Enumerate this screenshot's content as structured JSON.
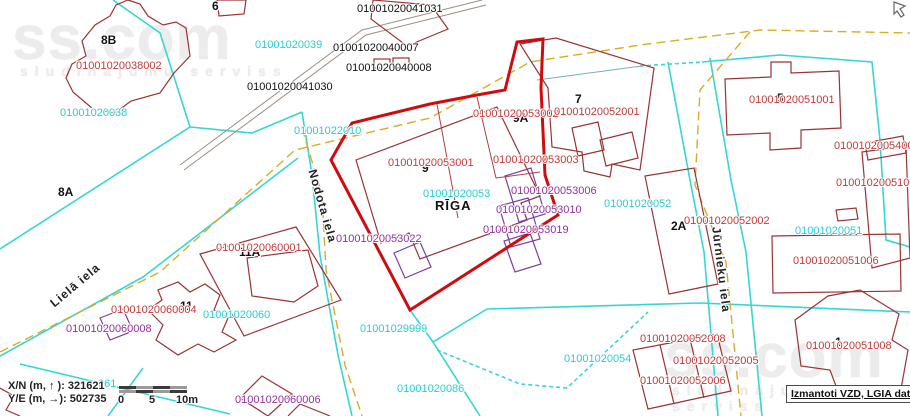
{
  "map_title": "Cadastral map",
  "city_label": "RĪGA",
  "watermark": {
    "brand": "ss.com",
    "slogan": "sludinājumu serviss"
  },
  "attribution": "Izmantoti VZD, LGIA dati",
  "info_panel": {
    "x_line": "X/N (m, ↑ ): 321621",
    "y_line": "Y/E (m, →): 502735"
  },
  "scale_bar": {
    "ticks": [
      "0",
      "5",
      "10m"
    ]
  },
  "streets": [
    "Lielā iela",
    "Nodota iela",
    "Jūrnieku iela"
  ],
  "selected_parcel": "01001020053",
  "colors": {
    "boundary_cyan": "#35d6d6",
    "road_yellow": "#d8ac28",
    "parcel_dark_red": "#993335",
    "selected_parcel_red": "#cf0b0d",
    "building_purple": "#7b3fa0",
    "label_cyan": "#2accd0",
    "label_red": "#c03a3a",
    "label_purple": "#93319c"
  },
  "labels": [
    {
      "text": "01001020041031",
      "x": 357,
      "y": 4,
      "cls": "num-black"
    },
    {
      "text": "01001020040007",
      "x": 333,
      "y": 43,
      "cls": "num-black"
    },
    {
      "text": "01001020040008",
      "x": 346,
      "y": 63,
      "cls": "num-black"
    },
    {
      "text": "01001020041030",
      "x": 247,
      "y": 82,
      "cls": "num-black"
    },
    {
      "text": "6",
      "x": 212,
      "y": 0,
      "cls": "addr"
    },
    {
      "text": "8B",
      "x": 101,
      "y": 34,
      "cls": "addr"
    },
    {
      "text": "8A",
      "x": 58,
      "y": 186,
      "cls": "addr"
    },
    {
      "text": "9",
      "x": 422,
      "y": 162,
      "cls": "addr"
    },
    {
      "text": "9A",
      "x": 513,
      "y": 112,
      "cls": "addr"
    },
    {
      "text": "7",
      "x": 575,
      "y": 93,
      "cls": "addr"
    },
    {
      "text": "2A",
      "x": 671,
      "y": 220,
      "cls": "addr"
    },
    {
      "text": "5",
      "x": 777,
      "y": 92,
      "cls": "addr"
    },
    {
      "text": "11A",
      "x": 239,
      "y": 246,
      "cls": "addr"
    },
    {
      "text": "11",
      "x": 180,
      "y": 300,
      "cls": "addr"
    },
    {
      "text": "1",
      "x": 835,
      "y": 336,
      "cls": "addr"
    },
    {
      "text": "RĪGA",
      "x": 435,
      "y": 199,
      "cls": "riga"
    },
    {
      "text": "01001020038002",
      "x": 76,
      "y": 61,
      "cls": "red"
    },
    {
      "text": "01001020053002",
      "x": 473,
      "y": 109,
      "cls": "red"
    },
    {
      "text": "01001020052001",
      "x": 554,
      "y": 107,
      "cls": "red"
    },
    {
      "text": "01001020053001",
      "x": 388,
      "y": 158,
      "cls": "red"
    },
    {
      "text": "01001020053003",
      "x": 493,
      "y": 155,
      "cls": "red"
    },
    {
      "text": "01001020051001",
      "x": 749,
      "y": 95,
      "cls": "red"
    },
    {
      "text": "01001020054002",
      "x": 834,
      "y": 141,
      "cls": "red"
    },
    {
      "text": "01001020051003",
      "x": 836,
      "y": 178,
      "cls": "red"
    },
    {
      "text": "01001020052002",
      "x": 684,
      "y": 216,
      "cls": "red"
    },
    {
      "text": "01001020051006",
      "x": 793,
      "y": 256,
      "cls": "red"
    },
    {
      "text": "01001020060001",
      "x": 216,
      "y": 243,
      "cls": "red"
    },
    {
      "text": "01001020060004",
      "x": 111,
      "y": 305,
      "cls": "red"
    },
    {
      "text": "01001020052008",
      "x": 640,
      "y": 334,
      "cls": "red"
    },
    {
      "text": "01001020052005",
      "x": 673,
      "y": 356,
      "cls": "red"
    },
    {
      "text": "01001020052006",
      "x": 640,
      "y": 376,
      "cls": "red"
    },
    {
      "text": "01001020051008",
      "x": 806,
      "y": 341,
      "cls": "red"
    },
    {
      "text": "01001020053006",
      "x": 511,
      "y": 186,
      "cls": "purple"
    },
    {
      "text": "01001020053010",
      "x": 496,
      "y": 205,
      "cls": "purple"
    },
    {
      "text": "01001020053019",
      "x": 483,
      "y": 225,
      "cls": "purple"
    },
    {
      "text": "01001020053022",
      "x": 336,
      "y": 234,
      "cls": "purple"
    },
    {
      "text": "01001020060008",
      "x": 66,
      "y": 324,
      "cls": "purple"
    },
    {
      "text": "01001020060006",
      "x": 235,
      "y": 395,
      "cls": "purple"
    },
    {
      "text": "01001020039",
      "x": 255,
      "y": 40,
      "cls": "cyan"
    },
    {
      "text": "01001020038",
      "x": 60,
      "y": 108,
      "cls": "cyan"
    },
    {
      "text": "01001022010",
      "x": 294,
      "y": 126,
      "cls": "cyan"
    },
    {
      "text": "01001020053",
      "x": 423,
      "y": 189,
      "cls": "cyan"
    },
    {
      "text": "01001020052",
      "x": 604,
      "y": 199,
      "cls": "cyan"
    },
    {
      "text": "01001020051",
      "x": 795,
      "y": 226,
      "cls": "cyan"
    },
    {
      "text": "01001020060",
      "x": 203,
      "y": 310,
      "cls": "cyan"
    },
    {
      "text": "01001029999",
      "x": 360,
      "y": 324,
      "cls": "cyan"
    },
    {
      "text": "01001020086",
      "x": 397,
      "y": 384,
      "cls": "cyan"
    },
    {
      "text": "01001020054",
      "x": 564,
      "y": 354,
      "cls": "cyan"
    },
    {
      "text": "061",
      "x": 98,
      "y": 379,
      "cls": "cyan"
    },
    {
      "text": "Lielā iela",
      "x": 48,
      "y": 300,
      "cls": "street",
      "rot": -40
    },
    {
      "text": "Nodota iela",
      "x": 318,
      "y": 168,
      "cls": "street",
      "rot": 74
    },
    {
      "text": "Jūrnieku iela",
      "x": 722,
      "y": 226,
      "cls": "street",
      "rot": 83
    },
    {
      "text": "X/N (m, ↑ ): 321621",
      "x": 8,
      "y": 381,
      "cls": "info"
    },
    {
      "text": "Y/E (m, →): 502735",
      "x": 8,
      "y": 394,
      "cls": "info"
    },
    {
      "text": "0",
      "x": 118,
      "y": 395,
      "cls": "info"
    },
    {
      "text": "5",
      "x": 149,
      "y": 395,
      "cls": "info"
    },
    {
      "text": "10m",
      "x": 176,
      "y": 395,
      "cls": "info"
    }
  ]
}
